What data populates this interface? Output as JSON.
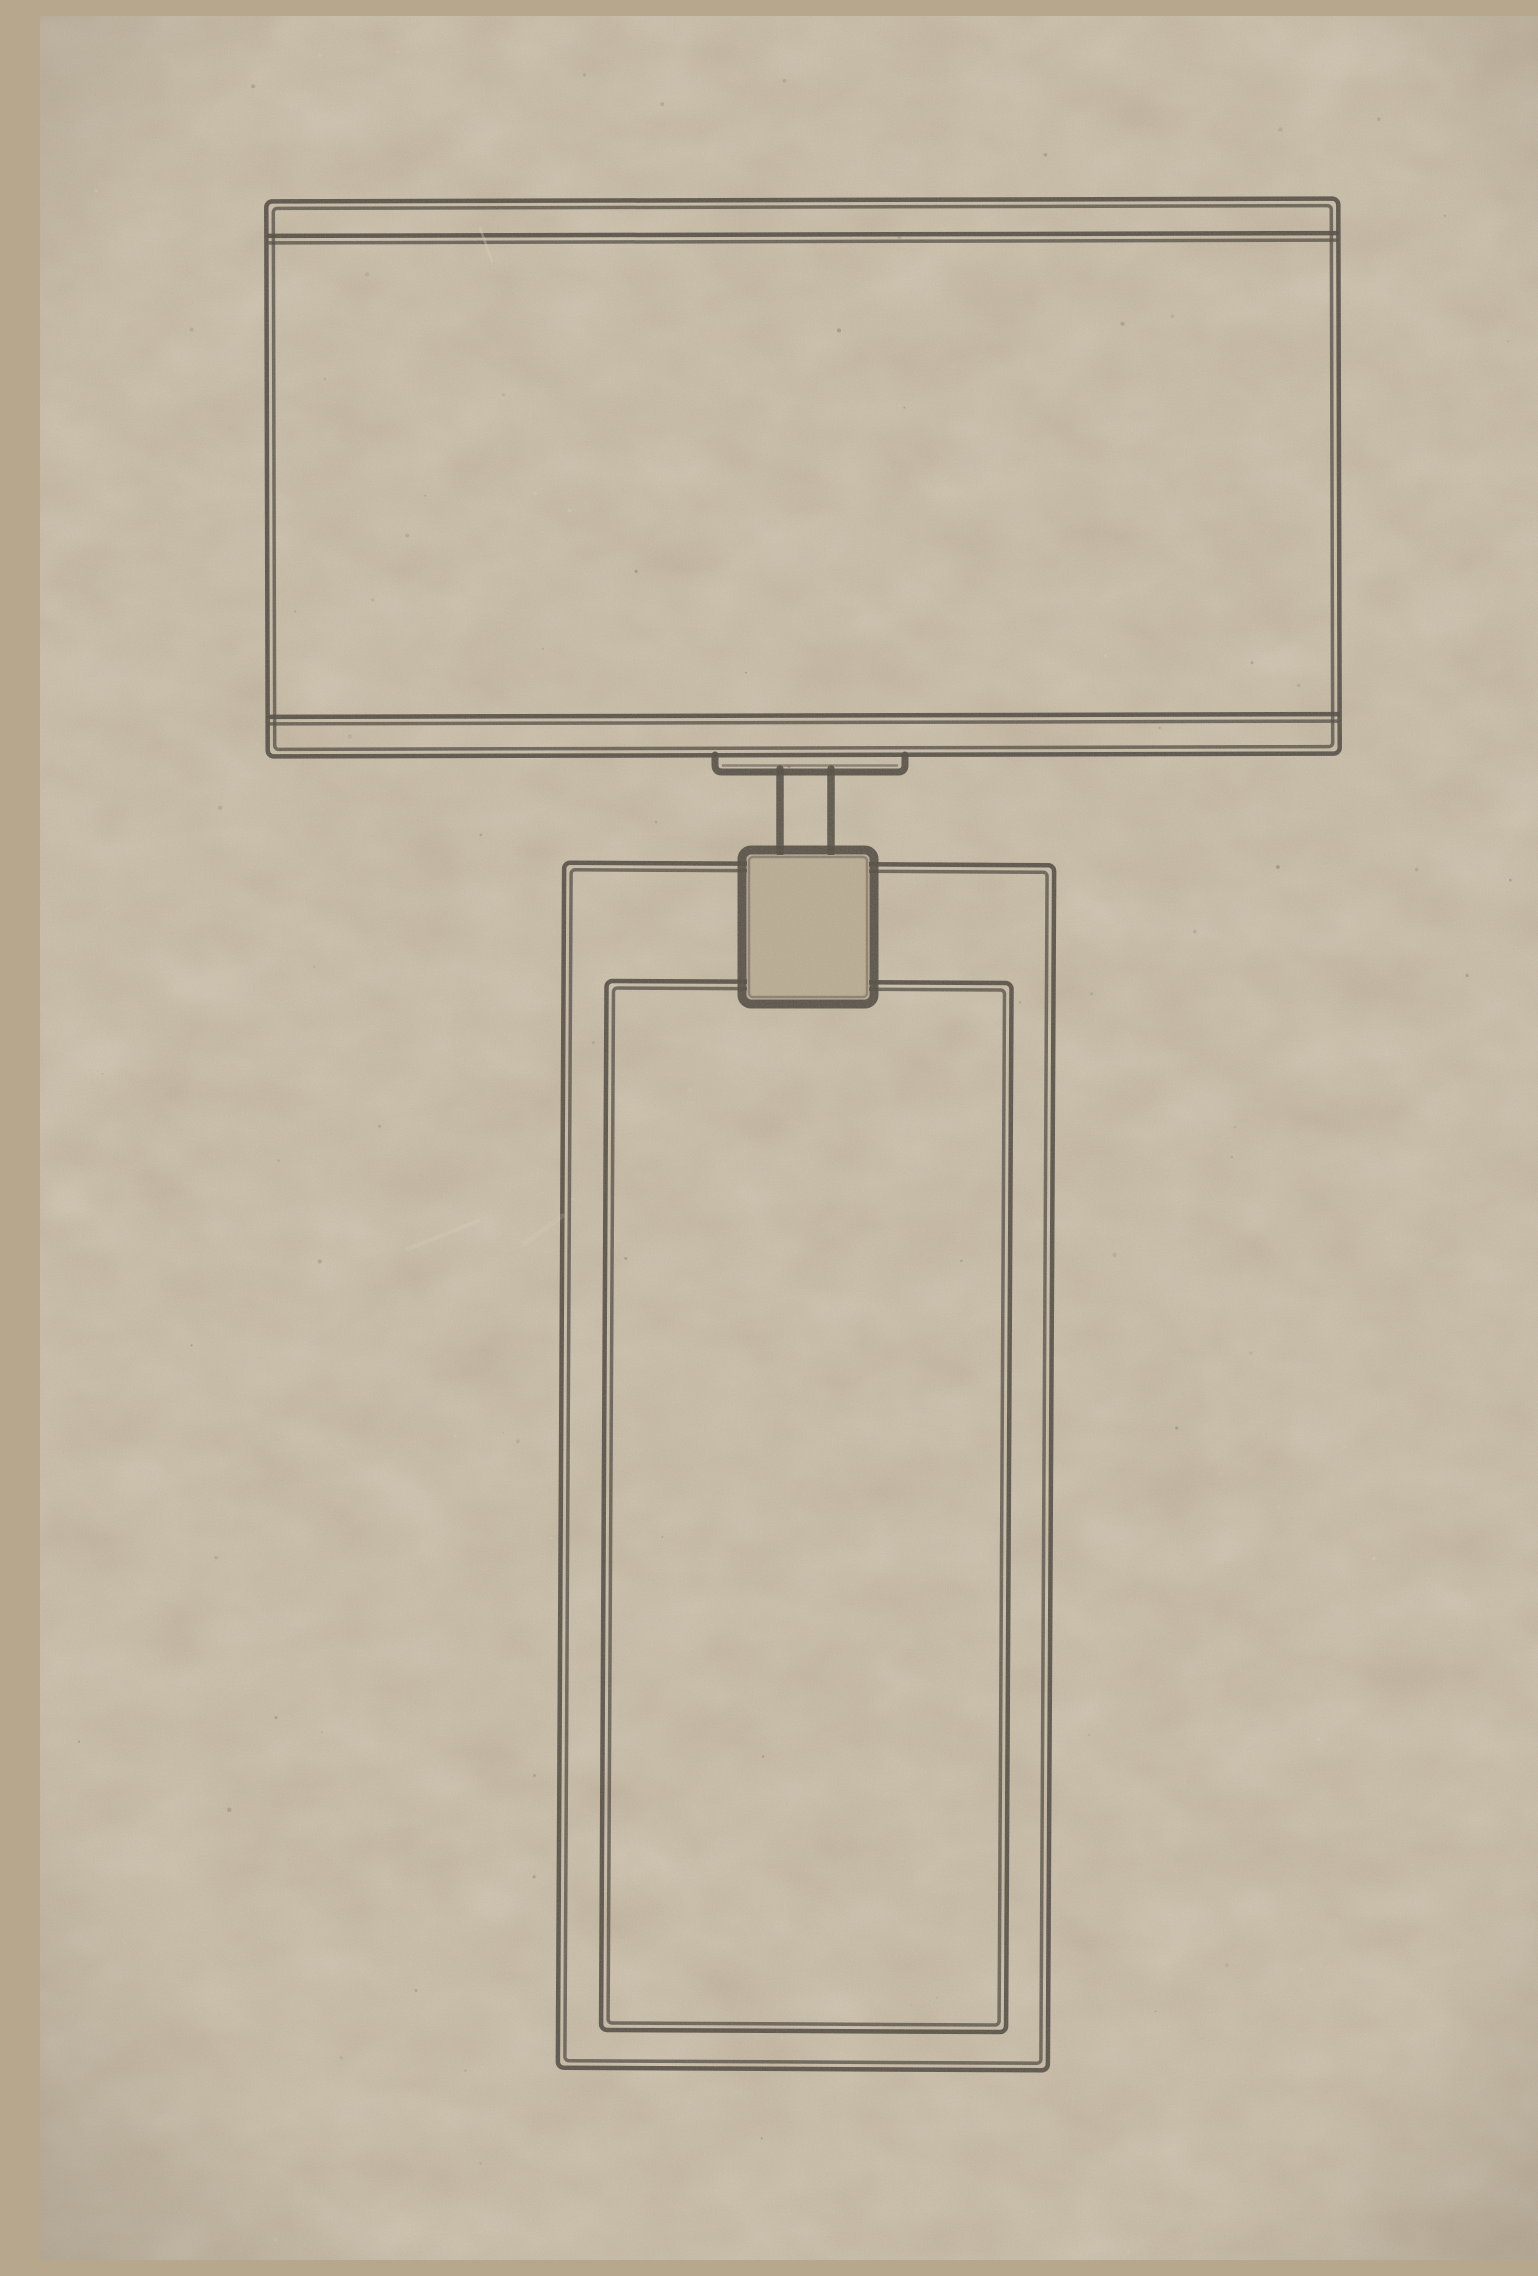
{
  "meta": {
    "canvas": {
      "width": 1538,
      "height": 2244
    }
  },
  "colors": {
    "background": "#b6a78d",
    "ink": "#332d26",
    "mottle_light": "#d6c8ac",
    "mottle_dark": "#8d7f66",
    "speck_dark": "#52493c",
    "speck_light": "#ddd3bd",
    "scratch": "#e2d8c3",
    "vignette": "#46392a"
  },
  "drawing": {
    "description": "Double-line ink illustration of a rectangular table lamp printed on kraft cardboard: wide box lampshade with inner trim lines, small saddle bracket and twin-line stem, square socket block, and a tall rectangular lamp body with an inset inner panel. No text anywhere on the board.",
    "parts": [
      {
        "name": "lampshade-outline",
        "type": "dline-rect",
        "x1": 227,
        "y1": 184,
        "x2": 1299,
        "y2": 739,
        "rotate": [
          -0.15,
          763,
          461
        ]
      },
      {
        "name": "lampshade-top-trim-line",
        "type": "dline-h",
        "y": 222,
        "x1": 230,
        "x2": 1297,
        "rotate": [
          -0.15,
          763,
          461
        ]
      },
      {
        "name": "lampshade-bottom-trim-line",
        "type": "dline-h",
        "y": 703,
        "x1": 230,
        "x2": 1297,
        "rotate": [
          -0.15,
          763,
          461
        ]
      },
      {
        "name": "harp-bracket",
        "type": "bracket",
        "x1": 675,
        "x2": 865,
        "yTop": 739,
        "yBottom": 756,
        "r": 7
      },
      {
        "name": "stem-left-line",
        "type": "line",
        "x1": 740,
        "y1": 753,
        "x2": 740,
        "y2": 837,
        "w": 7.5
      },
      {
        "name": "stem-right-line",
        "type": "line",
        "x1": 791,
        "y1": 753,
        "x2": 791,
        "y2": 837,
        "w": 7.5
      },
      {
        "name": "body-outline",
        "type": "dline-rect",
        "x1": 521,
        "y1": 848,
        "x2": 1011,
        "y2": 2053,
        "rotate": [
          0.3,
          766,
          1450
        ]
      },
      {
        "name": "body-inner-panel-outline",
        "type": "dline-rect",
        "x1": 564,
        "y1": 966,
        "x2": 969,
        "y2": 2015,
        "rotate": [
          0.3,
          766,
          1450
        ]
      },
      {
        "name": "socket-background-patch",
        "type": "patch",
        "x1": 707,
        "y1": 839,
        "x2": 829,
        "y2": 983
      },
      {
        "name": "socket-block",
        "type": "block",
        "x1": 702,
        "y1": 834,
        "x2": 834,
        "y2": 988,
        "rx": 9,
        "w": 9
      }
    ],
    "stroke": {
      "outer_width": 4.5,
      "echo_width": 3.5,
      "echo_inset": 7,
      "outer_opacity": 0.92,
      "echo_opacity": 0.78
    }
  },
  "texture": {
    "speck_seed": 13,
    "speck_count": 130,
    "scratches": [
      {
        "x1": 368,
        "y1": 1233,
        "x2": 438,
        "y2": 1205,
        "w": 4,
        "opacity": 0.26
      },
      {
        "x1": 484,
        "y1": 1228,
        "x2": 522,
        "y2": 1200,
        "w": 5,
        "opacity": 0.2
      },
      {
        "x1": 440,
        "y1": 212,
        "x2": 452,
        "y2": 245,
        "w": 2.5,
        "opacity": 0.35
      }
    ]
  }
}
